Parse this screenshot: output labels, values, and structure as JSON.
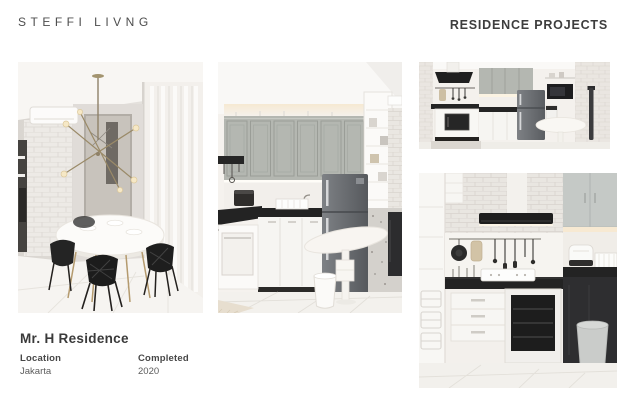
{
  "brand": {
    "logo_text": "STEFFI LIVNG"
  },
  "header": {
    "title": "RESIDENCE PROJECTS"
  },
  "project": {
    "name": "Mr. H Residence",
    "location_label": "Location",
    "location_value": "Jakarta",
    "completed_label": "Completed",
    "completed_value": "2020"
  },
  "gallery": {
    "photos": [
      {
        "id": "dining-area"
      },
      {
        "id": "kitchen-main"
      },
      {
        "id": "kitchen-wide-view"
      },
      {
        "id": "kitchen-cooking-detail"
      }
    ]
  },
  "colors": {
    "page_bg": "#ffffff",
    "text_dark": "#3d3d3d",
    "text_medium": "#5c5c5c",
    "cabinet_gray": "#b4b7b1",
    "counter_black": "#232323",
    "fridge_gray": "#6b6e72",
    "brick_white": "#eae6e1",
    "warm_glow": "#f6ead4",
    "brass": "#9a8a68"
  }
}
